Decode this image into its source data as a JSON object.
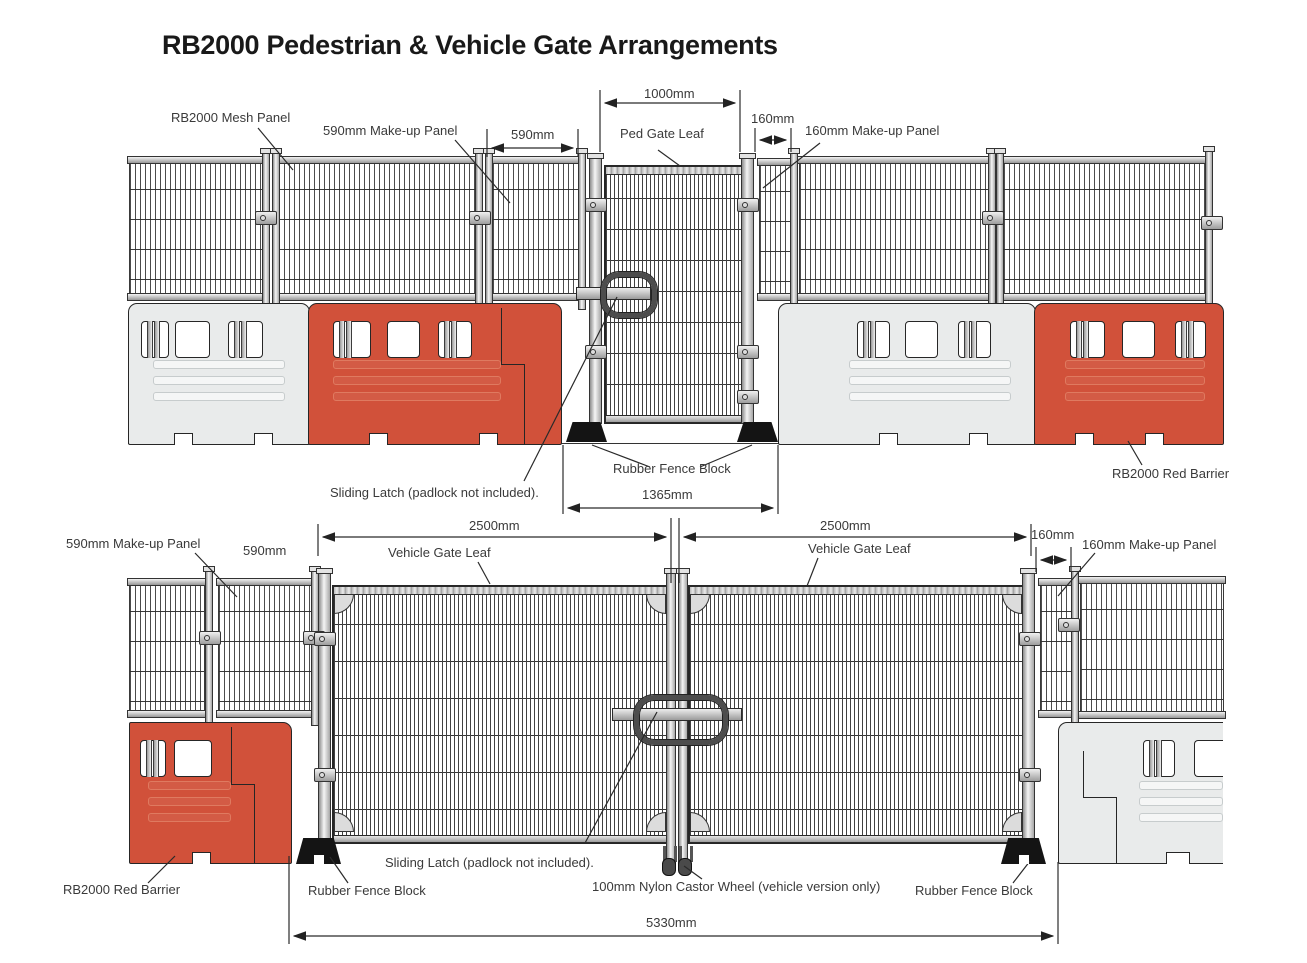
{
  "title": "RB2000 Pedestrian & Vehicle Gate Arrangements",
  "colors": {
    "red_barrier": "#d1513a",
    "gray_barrier": "#e9ebeb",
    "line": "#2a2a2a"
  },
  "pedestrian": {
    "labels": {
      "mesh_panel": "RB2000 Mesh Panel",
      "makeup_590": "590mm Make-up Panel",
      "ped_gate_leaf": "Ped Gate Leaf",
      "makeup_160": "160mm Make-up Panel",
      "sliding_latch": "Sliding Latch (padlock not included).",
      "rubber_block": "Rubber Fence Block",
      "red_barrier": "RB2000 Red Barrier"
    },
    "dims": {
      "d590": "590mm",
      "d1000": "1000mm",
      "d160": "160mm",
      "d1365": "1365mm"
    }
  },
  "vehicle": {
    "labels": {
      "makeup_590": "590mm Make-up Panel",
      "gate_leaf_left": "Vehicle Gate Leaf",
      "gate_leaf_right": "Vehicle Gate Leaf",
      "makeup_160": "160mm Make-up Panel",
      "red_barrier": "RB2000 Red Barrier",
      "sliding_latch": "Sliding Latch (padlock not included).",
      "rubber_block_left": "Rubber Fence Block",
      "rubber_block_right": "Rubber Fence Block",
      "castor": "100mm Nylon Castor Wheel (vehicle version only)"
    },
    "dims": {
      "d590": "590mm",
      "d2500_left": "2500mm",
      "d2500_right": "2500mm",
      "d160": "160mm",
      "d5330": "5330mm"
    }
  }
}
